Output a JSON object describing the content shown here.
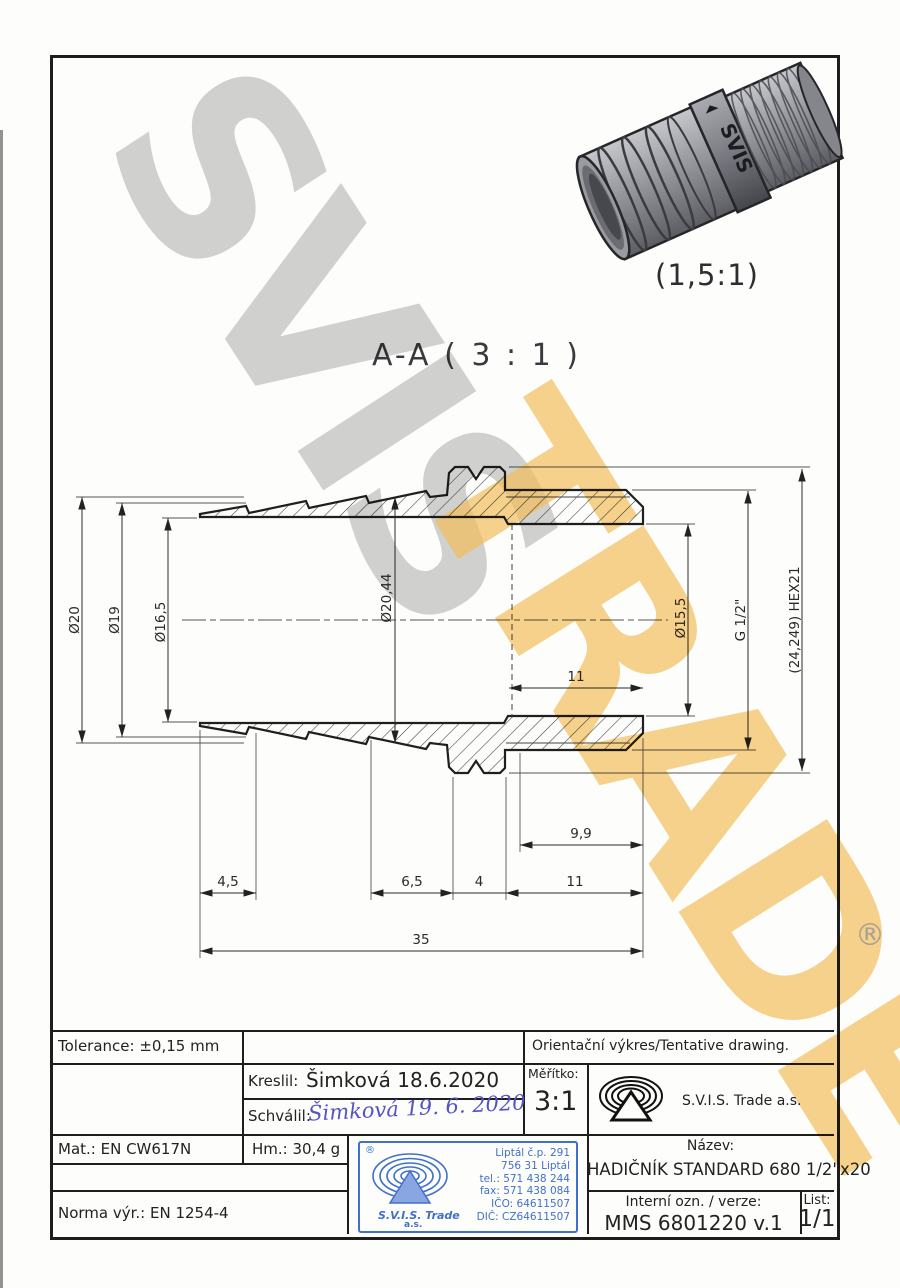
{
  "watermarks": {
    "gray": "SVIS",
    "amber": "TRADE",
    "registered": "®"
  },
  "photo": {
    "scale_label": "(1,5:1)",
    "brand": "SVIS"
  },
  "section": {
    "title": "A-A ( 3 : 1 )"
  },
  "dims": {
    "d20": "Ø20",
    "d19": "Ø19",
    "d16_5": "Ø16,5",
    "d20_44": "Ø20,44",
    "d15_5": "Ø15,5",
    "g": "G 1/2\"",
    "hex": "(24,249) HEX21",
    "l11_bore": "11",
    "l9_9": "9,9",
    "l4_5": "4,5",
    "l6_5": "6,5",
    "l4": "4",
    "l11": "11",
    "l35": "35"
  },
  "titleblock": {
    "tolerance": "Tolerance: ±0,15 mm",
    "orientacni": "Orientační výkres/Tentative drawing.",
    "kreslil_label": "Kreslil:",
    "kreslil_value": "Šimková 18.6.2020",
    "schvalil_label": "Schválil:",
    "schvalil_value": "Šimková 19. 6. 2020",
    "meritko_label": "Měřítko:",
    "meritko_value": "3:1",
    "company": "S.V.I.S. Trade a.s.",
    "mat": "Mat.: EN CW617N",
    "hm": "Hm.: 30,4 g",
    "norma": "Norma výr.: EN 1254-4",
    "nazev_label": "Název:",
    "nazev_value": "HADIČNÍK STANDARD 680 1/2\"x20",
    "interni_label": "Interní ozn. / verze:",
    "interni_value": "MMS 6801220 v.1",
    "list_label": "List:",
    "list_value": "1/1"
  },
  "stamp": {
    "registered": "®",
    "company": "S.V.I.S. Trade",
    "suffix": "a.s.",
    "address": [
      "Liptál č.p. 291",
      "756 31 Liptál",
      "tel.: 571 438 244",
      "fax: 571 438 084",
      "IČO: 64611507",
      "DIČ: CZ64611507"
    ]
  },
  "colors": {
    "stamp_blue": "#4070c8",
    "signature_blue": "#5353c6",
    "amber": "#f4c15c",
    "watermark_gray": "#c9c9c9",
    "line_dark": "#222222"
  }
}
